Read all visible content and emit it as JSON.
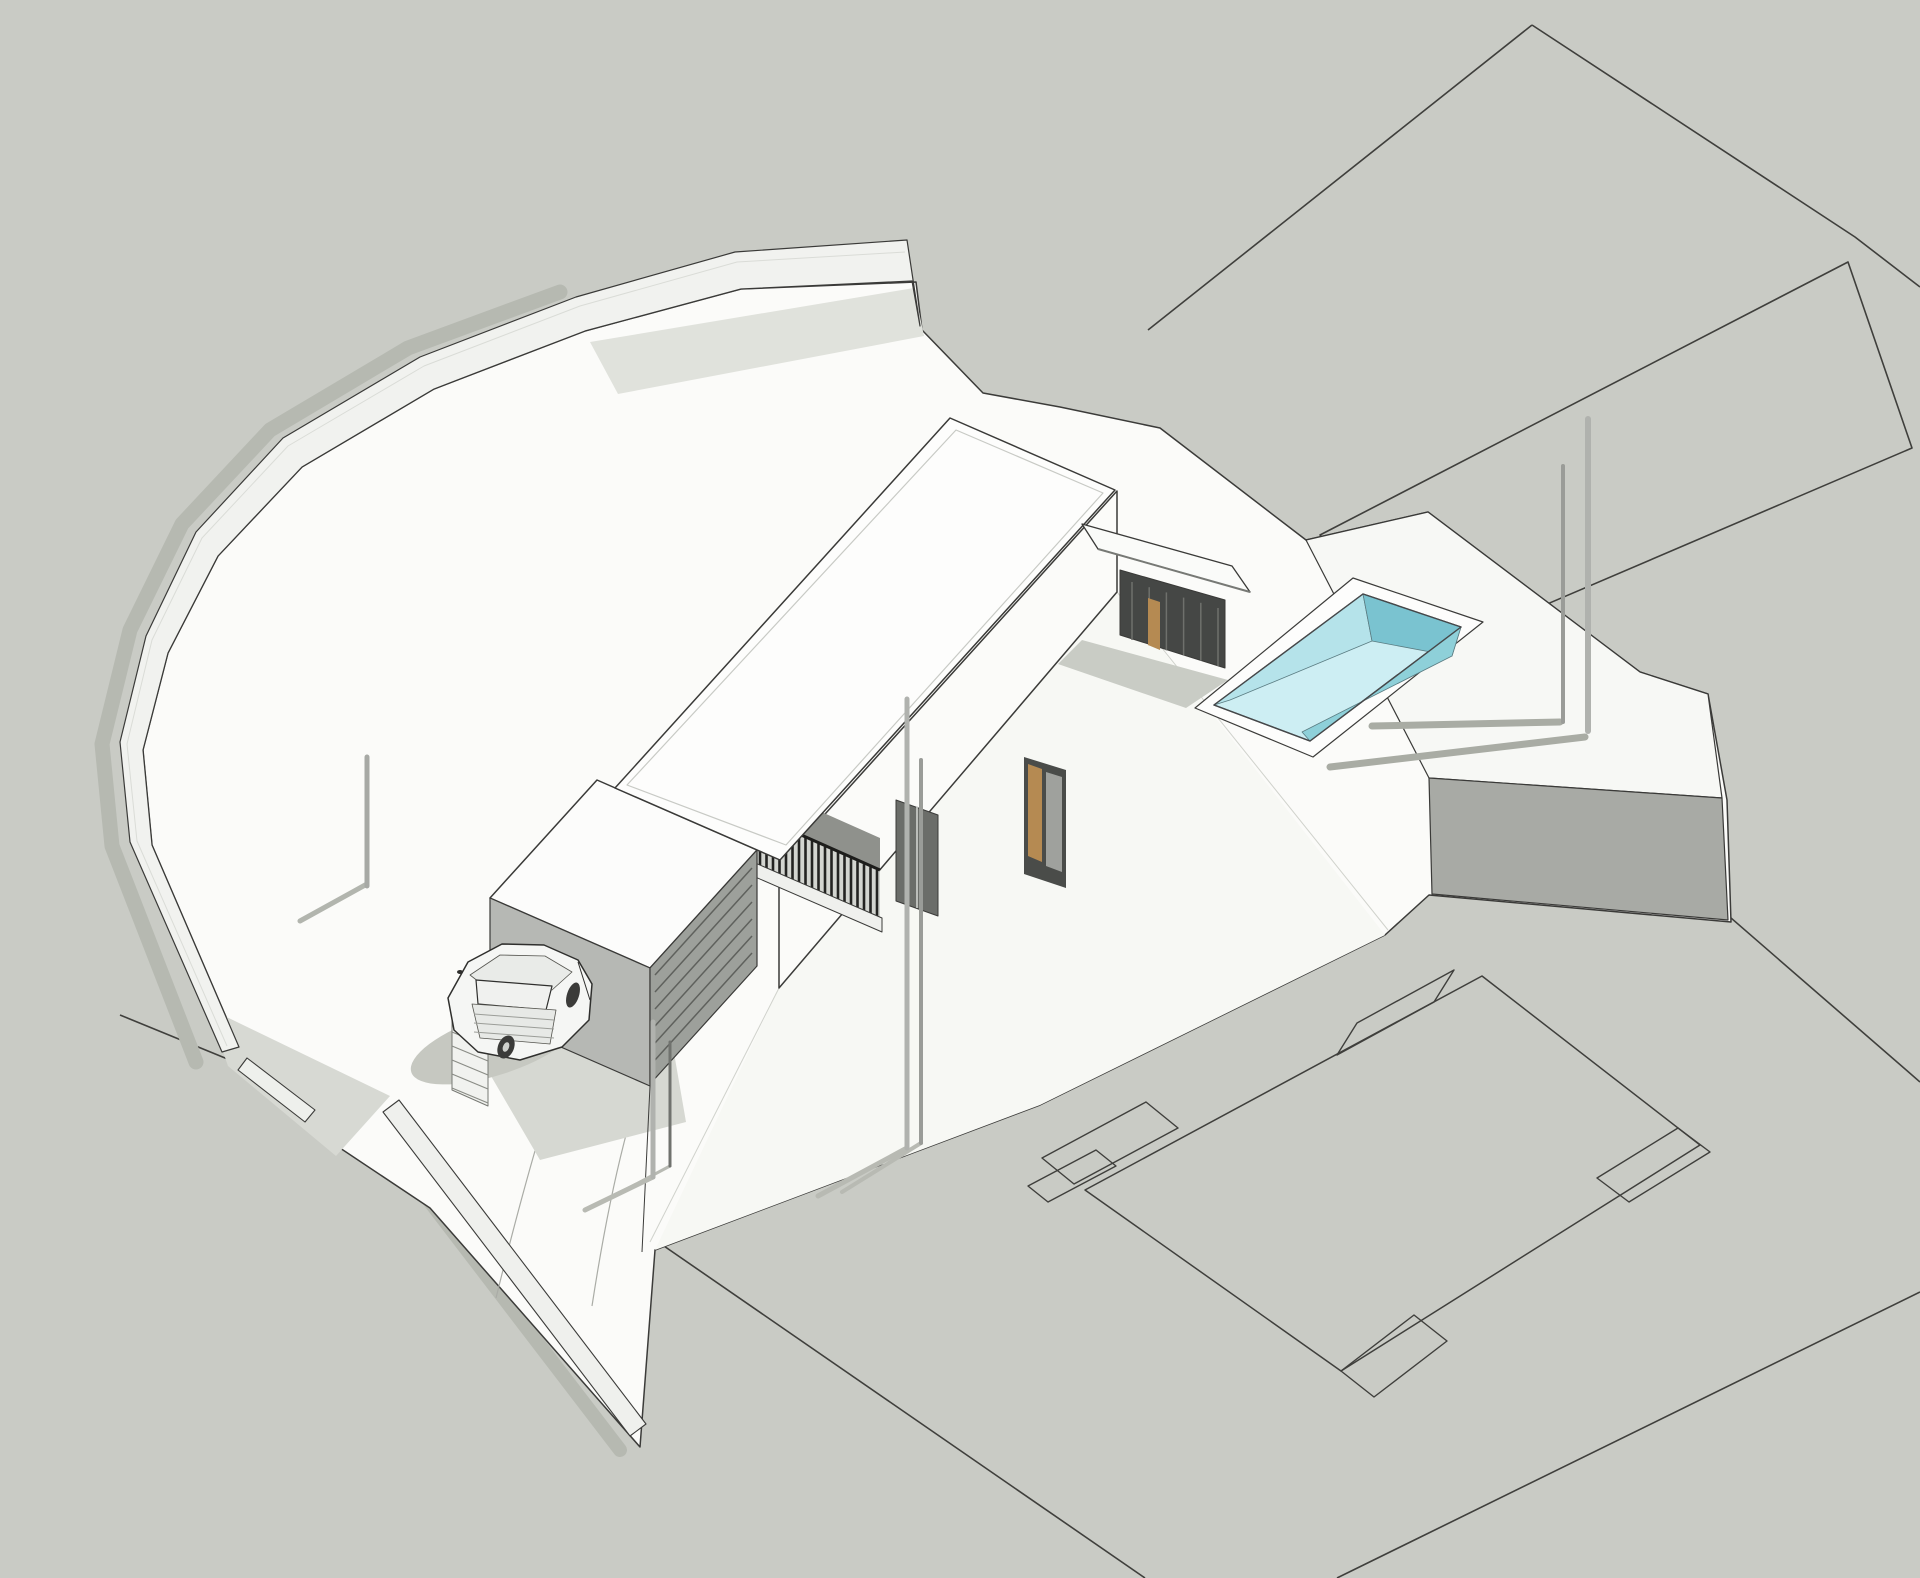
{
  "meta": {
    "description": "axonometric 3d site model of a two-story flat-roof house on a walled sloping plot",
    "canvas": {
      "width": 1920,
      "height": 1578,
      "background": "#c9cbc5"
    },
    "palette": {
      "ground_gray": "#c9cbc5",
      "terrain_white": "#fbfbf9",
      "line_dark": "#3d3d3a",
      "wall_white": "#f1f2ef",
      "shadow_on_gray": "#b6b9b1",
      "shadow_on_white": "#d6d8d2",
      "house_gray_wall": "#b6b8b4",
      "railing_dark": "#232321",
      "door_tan": "#b58a52",
      "pool_floor": "#cdeef3",
      "pool_near_wall": "#b5e3ea",
      "pool_far_wall": "#7ac3d0",
      "pool_right_wall": "#8ed0d9",
      "car_body": "#f5f6f4",
      "wheel_dark": "#3b3b39"
    },
    "objects": [
      "boundary-wall",
      "gate-wall",
      "driveway",
      "car",
      "stairs",
      "garage-door",
      "two-story-block",
      "main-roof",
      "balcony-railing",
      "entrance-canopy",
      "pool",
      "terrain-step-block",
      "site-posts",
      "neighbor-parcel-lines",
      "neighbor-building-footprint"
    ]
  },
  "shapes": [
    {
      "name": "ground-plane",
      "type": "polygon",
      "points": "0,0 1920,0 1920,1578 0,1578",
      "fill": "#c9cbc5"
    },
    {
      "name": "parcel-line-quad-left",
      "type": "polyline",
      "points": "1532,25 1148,330",
      "stroke": "#3f3f3c",
      "sw": 1.6
    },
    {
      "name": "parcel-line-quad-right",
      "type": "polyline",
      "points": "1532,25 1855,237 1920,287",
      "stroke": "#3f3f3c",
      "sw": 1.6
    },
    {
      "name": "parcel-strip-outline",
      "type": "polygon",
      "points": "1848,262 1320,535 1428,655 1912,448",
      "stroke": "#3f3f3c",
      "sw": 1.6
    },
    {
      "name": "parcel-line-long",
      "type": "polyline",
      "points": "1428,655 1920,1082",
      "stroke": "#3f3f3c",
      "sw": 1.6
    },
    {
      "name": "footprint-diamond",
      "type": "polygon",
      "points": "1482,976 1700,1145 1341,1371 1085,1190",
      "stroke": "#3f3f3c",
      "sw": 1.5
    },
    {
      "name": "footprint-notch-top",
      "type": "polygon",
      "points": "1434,1002 1337,1055 1357,1023 1454,970",
      "stroke": "#3f3f3c",
      "sw": 1.4
    },
    {
      "name": "footprint-notch-right",
      "type": "polygon",
      "points": "1678,1128 1597,1178 1629,1202 1710,1152",
      "stroke": "#3f3f3c",
      "sw": 1.4
    },
    {
      "name": "footprint-notch-bottom",
      "type": "polygon",
      "points": "1341,1371 1414,1315 1447,1341 1374,1397",
      "stroke": "#3f3f3c",
      "sw": 1.4
    },
    {
      "name": "footprint-notch-left",
      "type": "polygon",
      "points": "1042,1158 1146,1102 1178,1128 1074,1184",
      "stroke": "#3f3f3c",
      "sw": 1.4
    },
    {
      "name": "footprint-notch-left-small",
      "type": "polygon",
      "points": "1028,1186 1096,1150 1116,1166 1048,1202",
      "stroke": "#3f3f3c",
      "sw": 1.4
    },
    {
      "name": "street-curb-line",
      "type": "polyline",
      "points": "120,1015 640,1228",
      "stroke": "#3f3f3c",
      "sw": 1.6
    },
    {
      "name": "plot-boundary-line-south",
      "type": "polyline",
      "points": "648,1235 1145,1578",
      "stroke": "#3f3f3c",
      "sw": 1.6
    },
    {
      "name": "parcel-line-bottom-right",
      "type": "polyline",
      "points": "1920,1292 1337,1578",
      "stroke": "#3f3f3c",
      "sw": 1.6
    },
    {
      "name": "boundary-wall-shadow",
      "type": "polyline",
      "points": "196,1062 112,846 102,744 130,630 182,524 270,430 408,348 560,292",
      "stroke": "#b6b9b1",
      "sw": 15,
      "cap": "round"
    },
    {
      "name": "gate-wall-shadow",
      "type": "polyline",
      "points": "372,1126 620,1450",
      "stroke": "#b6b9b1",
      "sw": 14,
      "cap": "round"
    },
    {
      "name": "plot-terrain",
      "type": "polygon",
      "points": "239,1047 152,845 143,750 168,653 218,556 302,467 434,389 585,331 741,289 916,282 922,330 983,393 1060,407 1160,428 1306,540 1428,512 1640,672 1708,694 1727,800 1731,922 1429,895 1385,935 1040,1105 655,1250 640,1447 430,1208 310,1128",
      "fill": "#fbfbf9",
      "stroke": "#3b3b39",
      "sw": 1.5
    },
    {
      "name": "terrain-slope-facet",
      "type": "polygon",
      "points": "779,988 1117,592 1385,935 1040,1105 655,1250",
      "fill": "#f7f8f4"
    },
    {
      "name": "terrain-crease-right",
      "type": "line",
      "x1": 1117,
      "y1": 592,
      "x2": 1388,
      "y2": 930,
      "stroke": "#d0d2cc",
      "sw": 1
    },
    {
      "name": "terrain-crease-left",
      "type": "line",
      "x1": 779,
      "y1": 988,
      "x2": 650,
      "y2": 1242,
      "stroke": "#d0d2cc",
      "sw": 1
    },
    {
      "name": "driveway-track-left",
      "type": "path",
      "d": "M496,1298 Q540,1120 572,1038",
      "stroke": "#aaaca6",
      "sw": 1.2
    },
    {
      "name": "driveway-track-right",
      "type": "path",
      "d": "M592,1306 Q616,1150 648,1064",
      "stroke": "#aaaca6",
      "sw": 1.2
    },
    {
      "name": "wall-inner-shadow-top",
      "type": "polygon",
      "points": "590,342 914,288 924,336 618,394",
      "fill": "#e0e2dc"
    },
    {
      "name": "wall-inner-shadow-bottom",
      "type": "polygon",
      "points": "208,1008 390,1096 336,1156 228,1066",
      "fill": "#d7d9d3"
    },
    {
      "name": "terrain-step-top",
      "type": "polygon",
      "points": "1306,540 1428,512 1640,672 1708,694 1722,798 1429,778",
      "fill": "#f7f8f5",
      "stroke": "#3a3a38",
      "sw": 1.2
    },
    {
      "name": "terrain-step-front",
      "type": "polygon",
      "points": "1429,778 1722,798 1728,920 1432,894",
      "fill": "#a8aaa5",
      "stroke": "#3a3a38",
      "sw": 1.2
    },
    {
      "name": "boundary-wall",
      "type": "polygon",
      "points": "907,240 735,252 576,297 420,357 283,438 196,532 146,636 120,742 130,842 222,1052 239,1047 152,845 143,750 168,653 218,556 302,467 434,389 585,331 741,289 912,281 920,326",
      "fill": "#f1f2ef",
      "stroke": "#3a3a38",
      "sw": 1.2
    },
    {
      "name": "boundary-wall-ridge-line",
      "type": "polyline",
      "points": "905,252 737,262 580,306 424,366 288,446 202,538 152,640 127,744 137,841 227,1046",
      "stroke": "#dadcd7",
      "sw": 1
    },
    {
      "name": "gate-wall-corner-piece",
      "type": "polygon",
      "points": "247,1058 315,1110 305,1122 238,1070",
      "fill": "#eef0ec",
      "stroke": "#3b3b39",
      "sw": 1.1
    },
    {
      "name": "gate-wall",
      "type": "polygon",
      "points": "383,1112 630,1436 646,1424 399,1100",
      "fill": "#eff0ed",
      "stroke": "#3b3b39",
      "sw": 1.1
    },
    {
      "name": "house-ground-shadow",
      "type": "polygon",
      "points": "508,928 660,972 686,1122 540,1160 470,1040",
      "fill": "#d6d8d2"
    },
    {
      "name": "canopy-ground-shadow",
      "type": "polygon",
      "points": "1082,640 1228,680 1186,708 1058,664",
      "fill": "#c9ccc5"
    },
    {
      "name": "car-shadow",
      "type": "ellipse",
      "cx": 495,
      "cy": 1045,
      "rx": 88,
      "ry": 30,
      "rot": -18,
      "fill": "#c6c8c1"
    },
    {
      "name": "facade-se",
      "type": "polygon",
      "points": "1117,491 779,865 779,988 1117,592",
      "fill": "#fbfbf9",
      "stroke": "#3b3b39",
      "sw": 1.5
    },
    {
      "name": "facade-window-mid",
      "type": "polygon",
      "points": "896,800 938,815 938,916 896,901",
      "fill": "#6b6d69",
      "stroke": "#3b3b39",
      "sw": 1
    },
    {
      "name": "facade-window-mid-mullion",
      "type": "line",
      "x1": 917,
      "y1": 806,
      "x2": 917,
      "y2": 908,
      "stroke": "#d8dad6",
      "sw": 1.5
    },
    {
      "name": "facade-door-frame",
      "type": "polygon",
      "points": "1024,757 1066,770 1066,888 1024,874",
      "fill": "#4a4c49"
    },
    {
      "name": "facade-door-tan-panel",
      "type": "polygon",
      "points": "1028,764 1042,769 1042,862 1028,856",
      "fill": "#b58a52"
    },
    {
      "name": "facade-door-glass",
      "type": "polygon",
      "points": "1046,772 1062,777 1062,872 1046,866",
      "fill": "#9fa19d"
    },
    {
      "name": "balcony-back-wall",
      "type": "polygon",
      "points": "718,766 880,838 880,874 718,802",
      "fill": "#8f918c"
    },
    {
      "name": "balcony-door-frame",
      "type": "polygon",
      "points": "792,748 824,761 824,812 792,799",
      "fill": "#4a4c49"
    },
    {
      "name": "balcony-door-tan-panel",
      "type": "polygon",
      "points": "796,754 812,760 812,804 796,797",
      "fill": "#b58a52"
    },
    {
      "name": "balcony-railing-backdrop",
      "type": "polygon",
      "points": "718,798 880,870 880,920 718,848",
      "fill": "#d3d5d0"
    },
    {
      "name": "balcony-railing-slats",
      "type": "fence",
      "a": [
        721,
        849
      ],
      "b": [
        877,
        919
      ],
      "n": 25,
      "h": 49,
      "stroke": "#232321",
      "sw": 2.6
    },
    {
      "name": "balcony-railing-top-rail",
      "type": "line",
      "x1": 718,
      "y1": 798,
      "x2": 880,
      "y2": 870,
      "stroke": "#1d1d1b",
      "sw": 3
    },
    {
      "name": "balcony-slab-edge",
      "type": "polygon",
      "points": "716,846 882,918 882,932 716,860",
      "fill": "#eff0ed",
      "stroke": "#3b3b39",
      "sw": 1
    },
    {
      "name": "block-roof",
      "type": "polygon",
      "points": "597,780 490,898 650,968 757,850",
      "fill": "#fcfcfb",
      "stroke": "#3a3a38",
      "sw": 1.5
    },
    {
      "name": "block-sw-wall",
      "type": "polygon",
      "points": "490,898 650,968 650,1086 490,1016",
      "fill": "#b6b8b4",
      "stroke": "#3a3a38",
      "sw": 1.2
    },
    {
      "name": "block-sw-window",
      "type": "polygon",
      "points": "542,952 584,969 584,1002 542,985",
      "fill": "#3f413e"
    },
    {
      "name": "garage-face",
      "type": "polygon",
      "points": "650,968 757,850 757,966 650,1084",
      "fill": "#9da09b",
      "stroke": "#3a3a38",
      "sw": 1.2
    },
    {
      "name": "garage-door-slats",
      "type": "lamella",
      "a": [
        655,
        975
      ],
      "b": [
        752,
        868
      ],
      "n": 6,
      "d": [
        0,
        17
      ],
      "stroke": "#5f615d",
      "sw": 1.5
    },
    {
      "name": "exterior-stairs",
      "type": "polygon",
      "points": "452,1000 488,1015 488,1106 452,1090",
      "fill": "#f1f2ef",
      "stroke": "#777974",
      "sw": 1
    },
    {
      "name": "stair-steps",
      "type": "lamella",
      "a": [
        452,
        1004
      ],
      "b": [
        488,
        1019
      ],
      "n": 7,
      "d": [
        0,
        14
      ],
      "stroke": "#8a8c86",
      "sw": 1.2
    },
    {
      "name": "driveway-ramp-edge",
      "type": "line",
      "x1": 650,
      "y1": 1086,
      "x2": 642,
      "y2": 1252,
      "stroke": "#3b3b39",
      "sw": 1
    },
    {
      "name": "main-roof",
      "type": "polygon",
      "points": "950,418 1115,490 780,860 615,788",
      "fill": "#fdfdfc",
      "stroke": "#3a3a38",
      "sw": 1.5
    },
    {
      "name": "roof-parapet-inner-line",
      "type": "polygon",
      "points": "956,430 1103,493 786,845 627,785",
      "stroke": "#c8cac5",
      "sw": 1.2
    },
    {
      "name": "entrance-canopy",
      "type": "polygon",
      "points": "1082,524 1232,566 1250,592 1098,549",
      "fill": "#fafbf9",
      "stroke": "#3a3a38",
      "sw": 1.3
    },
    {
      "name": "canopy-under-edge",
      "type": "line",
      "x1": 1098,
      "y1": 549,
      "x2": 1250,
      "y2": 592,
      "stroke": "#777975",
      "sw": 2
    },
    {
      "name": "entrance-recess",
      "type": "polygon",
      "points": "1120,570 1225,600 1225,668 1120,635",
      "fill": "#454745",
      "stroke": "#3a3a38",
      "sw": 1
    },
    {
      "name": "entrance-glass-mullions",
      "type": "fence",
      "a": [
        1132,
        640
      ],
      "b": [
        1218,
        666
      ],
      "n": 6,
      "h": 58,
      "stroke": "#6e706c",
      "sw": 1.5
    },
    {
      "name": "entrance-door-tan-panel",
      "type": "polygon",
      "points": "1148,598 1160,602 1160,650 1148,645",
      "fill": "#b58a52"
    },
    {
      "name": "pool-deck",
      "type": "polygon",
      "points": "1353,578 1483,622 1313,757 1195,708",
      "fill": "#fdfdfc",
      "stroke": "#3b3b39",
      "sw": 1.2
    },
    {
      "name": "pool-basin",
      "type": "polygon",
      "points": "1363,594 1461,627 1310,741 1214,705",
      "fill": "#cdeef3",
      "stroke": "#46484a",
      "sw": 1.4
    },
    {
      "name": "pool-near-wall",
      "type": "polygon",
      "points": "1214,705 1363,594 1372,641 1230,700",
      "fill": "#b5e3ea",
      "stroke": "#5a7c82",
      "sw": 0.8
    },
    {
      "name": "pool-end-wall",
      "type": "polygon",
      "points": "1363,594 1461,627 1452,656 1372,641",
      "fill": "#7ac3d0",
      "stroke": "#5a7c82",
      "sw": 0.8
    },
    {
      "name": "pool-right-wall",
      "type": "polygon",
      "points": "1461,627 1310,741 1302,732 1452,656",
      "fill": "#8ed0d9",
      "stroke": "#5a7c82",
      "sw": 0.8
    },
    {
      "name": "pool-rim-outline",
      "type": "polygon",
      "points": "1363,594 1461,627 1310,741 1214,705",
      "stroke": "#46484a",
      "sw": 1.4
    },
    {
      "name": "post-shadow-right-1",
      "type": "line",
      "x1": 1560,
      "y1": 722,
      "x2": 1372,
      "y2": 726,
      "stroke": "#a9aca4",
      "sw": 7,
      "cap": "round"
    },
    {
      "name": "post-shadow-right-2",
      "type": "line",
      "x1": 1585,
      "y1": 737,
      "x2": 1330,
      "y2": 767,
      "stroke": "#a9aca4",
      "sw": 7,
      "cap": "round"
    },
    {
      "name": "post-shadow-left",
      "type": "line",
      "x1": 367,
      "y1": 884,
      "x2": 300,
      "y2": 921,
      "stroke": "#b2b5ae",
      "sw": 5,
      "cap": "round"
    },
    {
      "name": "post-shadow-mid-1",
      "type": "line",
      "x1": 907,
      "y1": 1148,
      "x2": 818,
      "y2": 1196,
      "stroke": "#b8bab3",
      "sw": 5,
      "cap": "round"
    },
    {
      "name": "post-shadow-mid-2",
      "type": "line",
      "x1": 921,
      "y1": 1143,
      "x2": 842,
      "y2": 1192,
      "stroke": "#b8bab3",
      "sw": 4,
      "cap": "round"
    },
    {
      "name": "post-shadow-gate-1",
      "type": "line",
      "x1": 653,
      "y1": 1177,
      "x2": 585,
      "y2": 1210,
      "stroke": "#b8bab3",
      "sw": 5,
      "cap": "round"
    },
    {
      "name": "post-shadow-gate-2",
      "type": "line",
      "x1": 670,
      "y1": 1166,
      "x2": 610,
      "y2": 1198,
      "stroke": "#b8bab3",
      "sw": 3,
      "cap": "round"
    },
    {
      "name": "site-post-left",
      "type": "line",
      "x1": 367,
      "y1": 757,
      "x2": 367,
      "y2": 886,
      "stroke": "#a7a9a5",
      "sw": 5,
      "cap": "round"
    },
    {
      "name": "site-post-gate-1",
      "type": "line",
      "x1": 653,
      "y1": 1022,
      "x2": 653,
      "y2": 1177,
      "stroke": "#b0b2ae",
      "sw": 5,
      "cap": "round"
    },
    {
      "name": "site-post-gate-2",
      "type": "line",
      "x1": 670,
      "y1": 1042,
      "x2": 670,
      "y2": 1166,
      "stroke": "#70726e",
      "sw": 3,
      "cap": "round"
    },
    {
      "name": "site-post-mid-1",
      "type": "line",
      "x1": 907,
      "y1": 699,
      "x2": 907,
      "y2": 1148,
      "stroke": "#b0b2ae",
      "sw": 5,
      "cap": "round"
    },
    {
      "name": "site-post-mid-2",
      "type": "line",
      "x1": 921,
      "y1": 760,
      "x2": 921,
      "y2": 1143,
      "stroke": "#9a9c98",
      "sw": 4,
      "cap": "round"
    },
    {
      "name": "site-post-right-1",
      "type": "line",
      "x1": 1563,
      "y1": 466,
      "x2": 1563,
      "y2": 722,
      "stroke": "#9a9c98",
      "sw": 4,
      "cap": "round"
    },
    {
      "name": "site-post-right-2",
      "type": "line",
      "x1": 1588,
      "y1": 419,
      "x2": 1588,
      "y2": 731,
      "stroke": "#b0b2ae",
      "sw": 6,
      "cap": "round"
    },
    {
      "name": "car-body",
      "type": "polygon",
      "points": "448,998 468,962 502,944 544,945 578,960 592,984 589,1020 562,1047 520,1060 478,1052 454,1030",
      "fill": "#f5f6f4",
      "stroke": "#2f2f2d",
      "sw": 1.5
    },
    {
      "name": "car-roof",
      "type": "polygon",
      "points": "470,975 500,955 545,956 572,972 552,990 492,992",
      "fill": "#e9ebe8",
      "stroke": "#55554f",
      "sw": 0.8
    },
    {
      "name": "car-rear-window",
      "type": "polygon",
      "points": "476,980 552,986 546,1010 478,1004",
      "fill": "#f0f1ef",
      "stroke": "#2f2f2d",
      "sw": 1.2
    },
    {
      "name": "car-tailgate",
      "type": "polygon",
      "points": "472,1004 556,1010 550,1044 480,1038",
      "fill": "#e7e9e6",
      "stroke": "#55554f",
      "sw": 0.8
    },
    {
      "name": "car-tailgate-lines",
      "type": "lamella",
      "a": [
        474,
        1014
      ],
      "b": [
        554,
        1020
      ],
      "n": 3,
      "d": [
        0,
        9
      ],
      "stroke": "#9b9d98",
      "sw": 1
    },
    {
      "name": "car-side-seam",
      "type": "line",
      "x1": 578,
      "y1": 962,
      "x2": 590,
      "y2": 1000,
      "stroke": "#2f2f2d",
      "sw": 1
    },
    {
      "name": "car-wheel-rear-right",
      "type": "ellipse",
      "cx": 573,
      "cy": 995,
      "rx": 6,
      "ry": 13,
      "rot": 18,
      "fill": "#3b3b39"
    },
    {
      "name": "car-wheel-rear-left",
      "type": "ellipse",
      "cx": 506,
      "cy": 1047,
      "rx": 8,
      "ry": 12,
      "rot": 22,
      "fill": "#3b3b39"
    },
    {
      "name": "car-wheel-hub",
      "type": "ellipse",
      "cx": 506,
      "cy": 1047,
      "rx": 3,
      "ry": 5,
      "rot": 22,
      "fill": "#cfd1cd"
    },
    {
      "name": "car-mirror",
      "type": "ellipse",
      "cx": 460,
      "cy": 972,
      "rx": 3,
      "ry": 2,
      "rot": 0,
      "fill": "#2f2f2d"
    }
  ]
}
